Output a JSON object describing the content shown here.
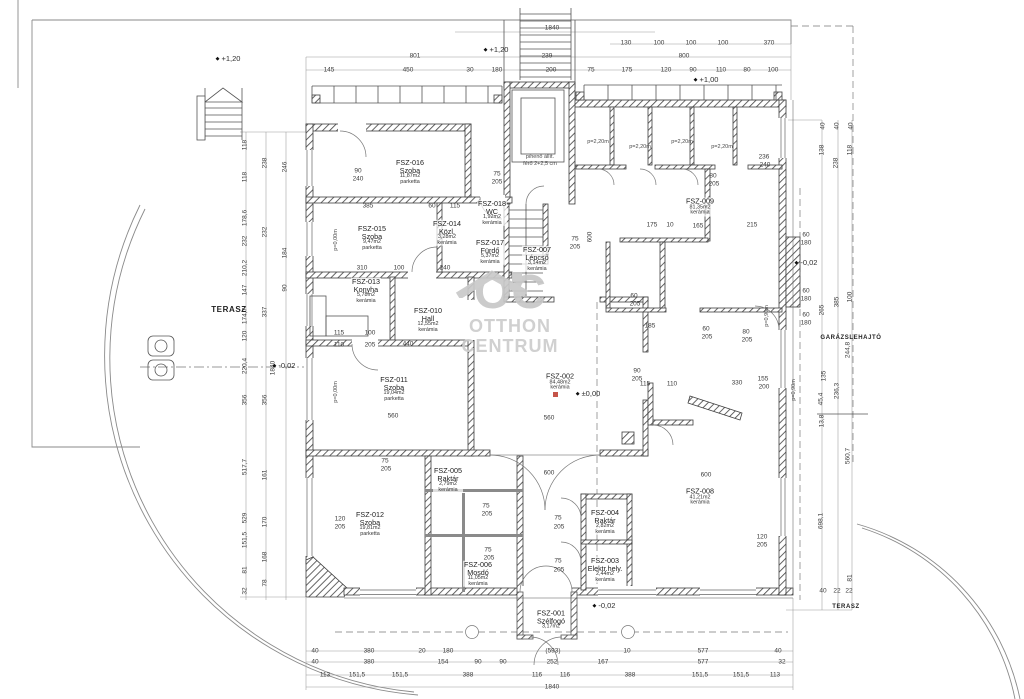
{
  "drawing": {
    "watermark": {
      "brand": "OC",
      "line1": "OTTHON",
      "line2": "CENTRUM",
      "gray": "#c8c8c8",
      "accent_color": "#c0453a"
    },
    "areas": [
      {
        "t": "TERASZ",
        "x": 229,
        "y": 310,
        "fs": 8
      },
      {
        "t": "GARÁZSLEHAJTÓ",
        "x": 851,
        "y": 338,
        "fs": 6
      },
      {
        "t": "TERASZ",
        "x": 846,
        "y": 607,
        "fs": 6
      }
    ],
    "levels": [
      {
        "t": "+1,20",
        "x": 228,
        "y": 59
      },
      {
        "t": "+1,20",
        "x": 496,
        "y": 50
      },
      {
        "t": "+1,00",
        "x": 706,
        "y": 80
      },
      {
        "t": "±0,00",
        "x": 588,
        "y": 394
      },
      {
        "t": "-0,02",
        "x": 284,
        "y": 366
      },
      {
        "t": "-0,02",
        "x": 604,
        "y": 606
      },
      {
        "t": "-0,02",
        "x": 806,
        "y": 263
      }
    ],
    "rooms": [
      {
        "x": 410,
        "y": 172,
        "lines": [
          "FSZ-016",
          "Szoba"
        ],
        "sub": [
          "11,87m2",
          "parketta"
        ]
      },
      {
        "x": 372,
        "y": 238,
        "lines": [
          "FSZ-015",
          "Szoba"
        ],
        "sub": [
          "9,47m2",
          "parketta"
        ]
      },
      {
        "x": 447,
        "y": 233,
        "lines": [
          "FSZ-014",
          "Közl."
        ],
        "sub": [
          "3,28m2",
          "kerámia"
        ]
      },
      {
        "x": 492,
        "y": 213,
        "lines": [
          "FSZ-018",
          "WC"
        ],
        "sub": [
          "1,92m2",
          "kerámia"
        ]
      },
      {
        "x": 490,
        "y": 252,
        "lines": [
          "FSZ-017",
          "Fürdő"
        ],
        "sub": [
          "5,37m2",
          "kerámia"
        ]
      },
      {
        "x": 366,
        "y": 291,
        "lines": [
          "FSZ-013",
          "Konyha"
        ],
        "sub": [
          "5,78m2",
          "kerámia"
        ]
      },
      {
        "x": 428,
        "y": 320,
        "lines": [
          "FSZ-010",
          "Hall"
        ],
        "sub": [
          "12,55m2",
          "kerámia"
        ]
      },
      {
        "x": 394,
        "y": 389,
        "lines": [
          "FSZ-011",
          "Szoba"
        ],
        "sub": [
          "19,04m2",
          "parketta"
        ]
      },
      {
        "x": 370,
        "y": 524,
        "lines": [
          "FSZ-012",
          "Szoba"
        ],
        "sub": [
          "19,81m2",
          "parketta"
        ]
      },
      {
        "x": 448,
        "y": 480,
        "lines": [
          "FSZ-005",
          "Raktár"
        ],
        "sub": [
          "2,79m2",
          "kerámia"
        ]
      },
      {
        "x": 478,
        "y": 574,
        "lines": [
          "FSZ-006",
          "Mosdó"
        ],
        "sub": [
          "11,05m2",
          "kerámia"
        ]
      },
      {
        "x": 537,
        "y": 259,
        "lines": [
          "FSZ-007",
          "Lépcső"
        ],
        "sub": [
          "3,14m2",
          "kerámia"
        ]
      },
      {
        "x": 560,
        "y": 382,
        "lines": [
          "FSZ-002"
        ],
        "sub": [
          "84,48m2",
          "kerámia"
        ]
      },
      {
        "x": 605,
        "y": 522,
        "lines": [
          "FSZ-004",
          "Raktár"
        ],
        "sub": [
          "2,82m2",
          "kerámia"
        ]
      },
      {
        "x": 605,
        "y": 570,
        "lines": [
          "FSZ-003",
          "Elektr.hely."
        ],
        "sub": [
          "2,44m2",
          "kerámia"
        ]
      },
      {
        "x": 551,
        "y": 620,
        "lines": [
          "FSZ-001",
          "Szélfogó"
        ],
        "sub": [
          "3,17m2"
        ]
      },
      {
        "x": 700,
        "y": 497,
        "lines": [
          "FSZ-008"
        ],
        "sub": [
          "41,21m2",
          "kerámia"
        ]
      },
      {
        "x": 700,
        "y": 207,
        "lines": [
          "FSZ-009"
        ],
        "sub": [
          "81,35m2",
          "kerámia"
        ]
      }
    ],
    "notes": [
      {
        "t": "p=2,20m",
        "x": 598,
        "y": 143
      },
      {
        "t": "p=2,20m",
        "x": 640,
        "y": 148
      },
      {
        "t": "p=2,20m",
        "x": 682,
        "y": 143
      },
      {
        "t": "p=2,20m",
        "x": 722,
        "y": 148
      },
      {
        "t": "p=0,00m",
        "x": 337,
        "y": 240,
        "r": 1
      },
      {
        "t": "p=0,00m",
        "x": 337,
        "y": 392,
        "r": 1
      },
      {
        "t": "p=0,90m",
        "x": 768,
        "y": 316,
        "r": 1
      },
      {
        "t": "p=0,90m",
        "x": 795,
        "y": 390,
        "r": 1
      },
      {
        "t": "pihenő állít.",
        "x": 540,
        "y": 158
      },
      {
        "t": "férő 2+2,5 cm",
        "x": 540,
        "y": 165
      }
    ],
    "dims": [
      {
        "t": "1840",
        "x": 552,
        "y": 29
      },
      {
        "t": "130",
        "x": 626,
        "y": 44
      },
      {
        "t": "100",
        "x": 659,
        "y": 44
      },
      {
        "t": "100",
        "x": 691,
        "y": 44
      },
      {
        "t": "100",
        "x": 723,
        "y": 44
      },
      {
        "t": "370",
        "x": 769,
        "y": 44
      },
      {
        "t": "801",
        "x": 415,
        "y": 57
      },
      {
        "t": "239",
        "x": 547,
        "y": 57
      },
      {
        "t": "800",
        "x": 684,
        "y": 57
      },
      {
        "t": "145",
        "x": 329,
        "y": 71
      },
      {
        "t": "450",
        "x": 408,
        "y": 71
      },
      {
        "t": "30",
        "x": 470,
        "y": 71
      },
      {
        "t": "180",
        "x": 497,
        "y": 71
      },
      {
        "t": "200",
        "x": 551,
        "y": 71
      },
      {
        "t": "75",
        "x": 591,
        "y": 71
      },
      {
        "t": "175",
        "x": 627,
        "y": 71
      },
      {
        "t": "120",
        "x": 666,
        "y": 71
      },
      {
        "t": "90",
        "x": 693,
        "y": 71
      },
      {
        "t": "110",
        "x": 721,
        "y": 71
      },
      {
        "t": "80",
        "x": 747,
        "y": 71
      },
      {
        "t": "100",
        "x": 773,
        "y": 71
      },
      {
        "t": "40",
        "x": 315,
        "y": 652
      },
      {
        "t": "380",
        "x": 369,
        "y": 652
      },
      {
        "t": "20",
        "x": 422,
        "y": 652
      },
      {
        "t": "180",
        "x": 448,
        "y": 652
      },
      {
        "t": "(593)",
        "x": 553,
        "y": 652
      },
      {
        "t": "10",
        "x": 627,
        "y": 652
      },
      {
        "t": "577",
        "x": 703,
        "y": 652
      },
      {
        "t": "40",
        "x": 778,
        "y": 652
      },
      {
        "t": "40",
        "x": 315,
        "y": 663
      },
      {
        "t": "380",
        "x": 369,
        "y": 663
      },
      {
        "t": "154",
        "x": 443,
        "y": 663
      },
      {
        "t": "90",
        "x": 478,
        "y": 663
      },
      {
        "t": "90",
        "x": 503,
        "y": 663
      },
      {
        "t": "252",
        "x": 552,
        "y": 663
      },
      {
        "t": "167",
        "x": 603,
        "y": 663
      },
      {
        "t": "577",
        "x": 703,
        "y": 663
      },
      {
        "t": "32",
        "x": 782,
        "y": 663
      },
      {
        "t": "113",
        "x": 325,
        "y": 676
      },
      {
        "t": "151,5",
        "x": 357,
        "y": 676
      },
      {
        "t": "151,5",
        "x": 400,
        "y": 676
      },
      {
        "t": "388",
        "x": 468,
        "y": 676
      },
      {
        "t": "116",
        "x": 537,
        "y": 676
      },
      {
        "t": "116",
        "x": 565,
        "y": 676
      },
      {
        "t": "388",
        "x": 630,
        "y": 676
      },
      {
        "t": "151,5",
        "x": 700,
        "y": 676
      },
      {
        "t": "151,5",
        "x": 741,
        "y": 676
      },
      {
        "t": "113",
        "x": 775,
        "y": 676
      },
      {
        "t": "1840",
        "x": 552,
        "y": 688
      },
      {
        "t": "118",
        "x": 246,
        "y": 145,
        "r": 1
      },
      {
        "t": "118",
        "x": 246,
        "y": 177,
        "r": 1
      },
      {
        "t": "178,6",
        "x": 246,
        "y": 218,
        "r": 1
      },
      {
        "t": "232",
        "x": 246,
        "y": 241,
        "r": 1
      },
      {
        "t": "210,2",
        "x": 246,
        "y": 268,
        "r": 1
      },
      {
        "t": "147",
        "x": 246,
        "y": 290,
        "r": 1
      },
      {
        "t": "174,7",
        "x": 246,
        "y": 316,
        "r": 1
      },
      {
        "t": "120",
        "x": 246,
        "y": 336,
        "r": 1
      },
      {
        "t": "220,4",
        "x": 246,
        "y": 366,
        "r": 1
      },
      {
        "t": "356",
        "x": 246,
        "y": 400,
        "r": 1
      },
      {
        "t": "517,7",
        "x": 246,
        "y": 467,
        "r": 1
      },
      {
        "t": "529",
        "x": 246,
        "y": 518,
        "r": 1
      },
      {
        "t": "151,5",
        "x": 246,
        "y": 540,
        "r": 1
      },
      {
        "t": "81",
        "x": 246,
        "y": 570,
        "r": 1
      },
      {
        "t": "32",
        "x": 246,
        "y": 591,
        "r": 1
      },
      {
        "t": "238",
        "x": 266,
        "y": 163,
        "r": 1
      },
      {
        "t": "232",
        "x": 266,
        "y": 232,
        "r": 1
      },
      {
        "t": "337",
        "x": 266,
        "y": 312,
        "r": 1
      },
      {
        "t": "356",
        "x": 266,
        "y": 400,
        "r": 1
      },
      {
        "t": "161",
        "x": 266,
        "y": 475,
        "r": 1
      },
      {
        "t": "170",
        "x": 266,
        "y": 522,
        "r": 1
      },
      {
        "t": "168",
        "x": 266,
        "y": 557,
        "r": 1
      },
      {
        "t": "78",
        "x": 266,
        "y": 583,
        "r": 1
      },
      {
        "t": "246",
        "x": 286,
        "y": 167,
        "r": 1
      },
      {
        "t": "184",
        "x": 286,
        "y": 253,
        "r": 1
      },
      {
        "t": "90",
        "x": 286,
        "y": 288,
        "r": 1
      },
      {
        "t": "1840",
        "x": 274,
        "y": 368,
        "r": 1
      },
      {
        "t": "40",
        "x": 824,
        "y": 126,
        "r": 1
      },
      {
        "t": "40",
        "x": 838,
        "y": 126,
        "r": 1
      },
      {
        "t": "40",
        "x": 852,
        "y": 126,
        "r": 1
      },
      {
        "t": "138",
        "x": 823,
        "y": 150,
        "r": 1
      },
      {
        "t": "118",
        "x": 851,
        "y": 150,
        "r": 1
      },
      {
        "t": "238",
        "x": 837,
        "y": 163,
        "r": 1
      },
      {
        "t": "385",
        "x": 838,
        "y": 302,
        "r": 1
      },
      {
        "t": "100",
        "x": 851,
        "y": 297,
        "r": 1
      },
      {
        "t": "265",
        "x": 823,
        "y": 310,
        "r": 1
      },
      {
        "t": "244,8",
        "x": 849,
        "y": 350,
        "r": 1
      },
      {
        "t": "135",
        "x": 825,
        "y": 376,
        "r": 1
      },
      {
        "t": "236,3",
        "x": 838,
        "y": 391,
        "r": 1
      },
      {
        "t": "45,4",
        "x": 822,
        "y": 399,
        "r": 1
      },
      {
        "t": "13,8",
        "x": 823,
        "y": 421,
        "r": 1
      },
      {
        "t": "560,7",
        "x": 849,
        "y": 456,
        "r": 1
      },
      {
        "t": "698,1",
        "x": 822,
        "y": 521,
        "r": 1
      },
      {
        "t": "81",
        "x": 851,
        "y": 578,
        "r": 1
      },
      {
        "t": "40",
        "x": 823,
        "y": 592
      },
      {
        "t": "22",
        "x": 837,
        "y": 592
      },
      {
        "t": "22",
        "x": 849,
        "y": 592
      },
      {
        "t": "90",
        "x": 358,
        "y": 172
      },
      {
        "t": "240",
        "x": 358,
        "y": 180
      },
      {
        "t": "75",
        "x": 497,
        "y": 175
      },
      {
        "t": "205",
        "x": 497,
        "y": 183
      },
      {
        "t": "385",
        "x": 368,
        "y": 207
      },
      {
        "t": "60",
        "x": 432,
        "y": 207
      },
      {
        "t": "115",
        "x": 455,
        "y": 207
      },
      {
        "t": "75",
        "x": 575,
        "y": 240
      },
      {
        "t": "205",
        "x": 575,
        "y": 248
      },
      {
        "t": "310",
        "x": 362,
        "y": 269
      },
      {
        "t": "100",
        "x": 399,
        "y": 269
      },
      {
        "t": "240",
        "x": 445,
        "y": 269
      },
      {
        "t": "115",
        "x": 339,
        "y": 334
      },
      {
        "t": "100",
        "x": 370,
        "y": 334
      },
      {
        "t": "110",
        "x": 339,
        "y": 346
      },
      {
        "t": "205",
        "x": 370,
        "y": 346
      },
      {
        "t": "440",
        "x": 408,
        "y": 345
      },
      {
        "t": "560",
        "x": 393,
        "y": 417
      },
      {
        "t": "600",
        "x": 591,
        "y": 237,
        "r": 1
      },
      {
        "t": "560",
        "x": 549,
        "y": 419
      },
      {
        "t": "600",
        "x": 549,
        "y": 474
      },
      {
        "t": "600",
        "x": 706,
        "y": 476
      },
      {
        "t": "330",
        "x": 737,
        "y": 384
      },
      {
        "t": "115",
        "x": 645,
        "y": 385
      },
      {
        "t": "110",
        "x": 672,
        "y": 385
      },
      {
        "t": "90",
        "x": 637,
        "y": 372
      },
      {
        "t": "205",
        "x": 637,
        "y": 380
      },
      {
        "t": "175",
        "x": 652,
        "y": 226
      },
      {
        "t": "10",
        "x": 670,
        "y": 226
      },
      {
        "t": "165",
        "x": 698,
        "y": 227
      },
      {
        "t": "215",
        "x": 752,
        "y": 226
      },
      {
        "t": "236",
        "x": 764,
        "y": 158
      },
      {
        "t": "240",
        "x": 765,
        "y": 166
      },
      {
        "t": "185",
        "x": 650,
        "y": 327
      },
      {
        "t": "80",
        "x": 713,
        "y": 177
      },
      {
        "t": "205",
        "x": 714,
        "y": 185
      },
      {
        "t": "80",
        "x": 746,
        "y": 333
      },
      {
        "t": "205",
        "x": 747,
        "y": 341
      },
      {
        "t": "60",
        "x": 706,
        "y": 330
      },
      {
        "t": "205",
        "x": 707,
        "y": 338
      },
      {
        "t": "60",
        "x": 634,
        "y": 297
      },
      {
        "t": "205",
        "x": 635,
        "y": 305
      },
      {
        "t": "155",
        "x": 763,
        "y": 380
      },
      {
        "t": "200",
        "x": 764,
        "y": 388
      },
      {
        "t": "120",
        "x": 762,
        "y": 538
      },
      {
        "t": "205",
        "x": 762,
        "y": 546
      },
      {
        "t": "75",
        "x": 558,
        "y": 519
      },
      {
        "t": "205",
        "x": 559,
        "y": 528
      },
      {
        "t": "75",
        "x": 558,
        "y": 562
      },
      {
        "t": "205",
        "x": 559,
        "y": 571
      },
      {
        "t": "75",
        "x": 486,
        "y": 507
      },
      {
        "t": "205",
        "x": 487,
        "y": 515
      },
      {
        "t": "75",
        "x": 488,
        "y": 551
      },
      {
        "t": "205",
        "x": 489,
        "y": 559
      },
      {
        "t": "75",
        "x": 385,
        "y": 462
      },
      {
        "t": "205",
        "x": 386,
        "y": 470
      },
      {
        "t": "120",
        "x": 340,
        "y": 520
      },
      {
        "t": "205",
        "x": 340,
        "y": 528
      },
      {
        "t": "60",
        "x": 806,
        "y": 236
      },
      {
        "t": "180",
        "x": 806,
        "y": 244
      },
      {
        "t": "60",
        "x": 806,
        "y": 292
      },
      {
        "t": "180",
        "x": 806,
        "y": 300
      },
      {
        "t": "60",
        "x": 806,
        "y": 316
      },
      {
        "t": "180",
        "x": 806,
        "y": 324
      }
    ]
  }
}
